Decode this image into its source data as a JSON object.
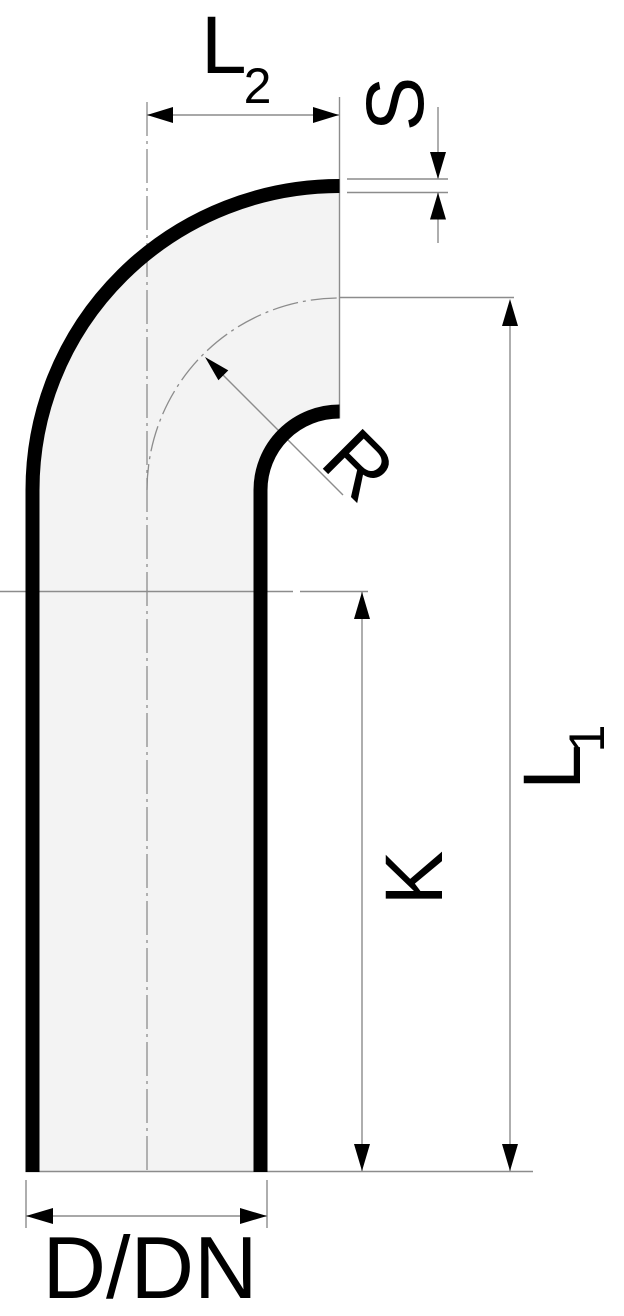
{
  "drawing": {
    "labels": {
      "l2": {
        "main": "L",
        "sub": "2"
      },
      "s": "S",
      "r": "R",
      "k": "K",
      "l1": {
        "main": "L",
        "sub": "1"
      },
      "diameter": "D/DN"
    },
    "colors": {
      "outline": "#000000",
      "silhouette_fill": "#f3f3f3",
      "dimension_line": "#8c8c8c",
      "background": "#ffffff"
    }
  }
}
